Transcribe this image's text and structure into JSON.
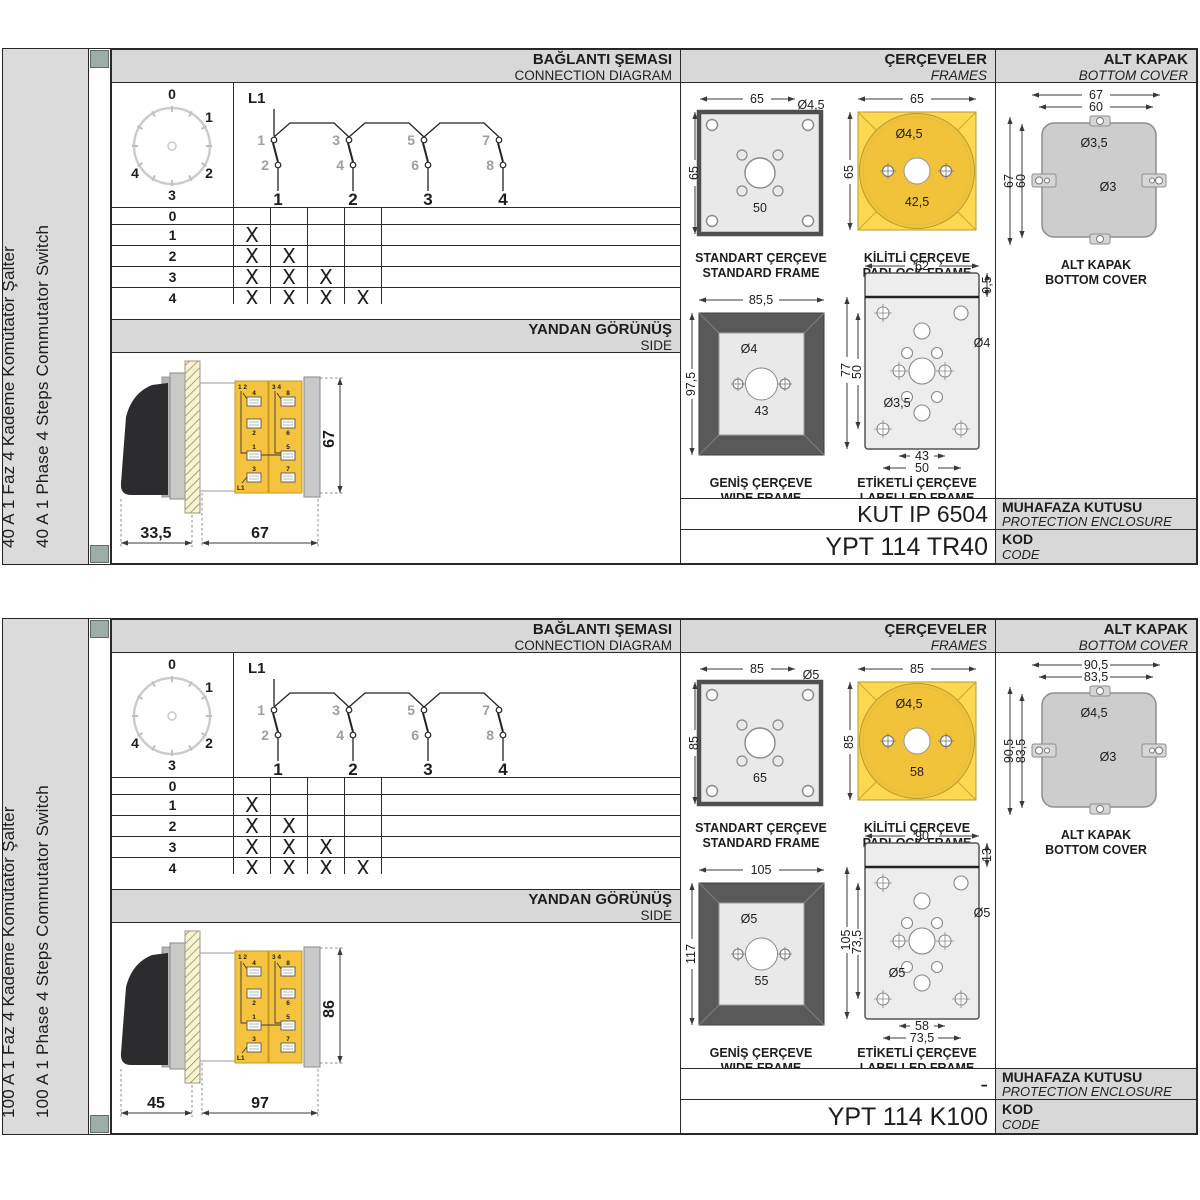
{
  "colors": {
    "header_gray": "#D8D8D8",
    "tab_green": "#9FADA9",
    "switch_yellow": "#F6C33E",
    "padlock_yellow": "#FDD850",
    "padlock_circle": "#F3C23B",
    "frame_dark": "#595959",
    "cover_gray": "#CDCDCD",
    "dial_ring": "#C7CECA"
  },
  "sections": [
    {
      "label_tr": "40 A 1 Faz 4 Kademe Komütatör Şalter",
      "label_en": "40 A 1 Phase 4 Steps Commutator Switch",
      "hdr_conn_tr": "BAĞLANTI ŞEMASI",
      "hdr_conn_en": "CONNECTION DIAGRAM",
      "hdr_frames_tr": "ÇERÇEVELER",
      "hdr_frames_en": "FRAMES",
      "hdr_cover_tr": "ALT KAPAK",
      "hdr_cover_en": "BOTTOM COVER",
      "hdr_side_tr": "YANDAN GÖRÜNÜŞ",
      "hdr_side_en": "SIDE",
      "dial": {
        "positions": [
          "0",
          "1",
          "2",
          "3",
          "4"
        ]
      },
      "schem": {
        "source": "L1",
        "top": [
          "1",
          "3",
          "5",
          "7"
        ],
        "bottom": [
          "2",
          "4",
          "6",
          "8"
        ],
        "cols": [
          "1",
          "2",
          "3",
          "4"
        ]
      },
      "table": {
        "rows": [
          {
            "label": "0",
            "marks": [
              "",
              "",
              "",
              ""
            ]
          },
          {
            "label": "1",
            "marks": [
              "X",
              "",
              "",
              ""
            ]
          },
          {
            "label": "2",
            "marks": [
              "X",
              "X",
              "",
              ""
            ]
          },
          {
            "label": "3",
            "marks": [
              "X",
              "X",
              "X",
              ""
            ]
          },
          {
            "label": "4",
            "marks": [
              "X",
              "X",
              "X",
              "X"
            ]
          }
        ]
      },
      "side": {
        "dim_a": "33,5",
        "dim_b": "67",
        "dim_h": "67",
        "modules": [
          {
            "corner": "1 2",
            "t1": "4",
            "t2": "2",
            "t3": "1",
            "t4": "3",
            "source": "L1"
          },
          {
            "corner": "3 4",
            "t1": "8",
            "t2": "6",
            "t3": "5",
            "t4": "7",
            "source": ""
          }
        ]
      },
      "frames": {
        "standard": {
          "tr": "STANDART ÇERÇEVE",
          "en": "STANDARD FRAME",
          "w": "65",
          "h": "65",
          "hole": "Ø4,5",
          "inner": "50"
        },
        "padlock": {
          "tr": "KİLİTLİ ÇERÇEVE",
          "en": "PADLOCK FRAME",
          "w": "65",
          "h": "65",
          "hole": "Ø4,5",
          "inner": "42,5"
        },
        "wide": {
          "tr": "GENİŞ ÇERÇEVE",
          "en": "WIDE FRAME",
          "w": "85,5",
          "h": "97,5",
          "hole": "Ø4",
          "inner": "43"
        },
        "labelled": {
          "tr": "ETİKETLİ ÇERÇEVE",
          "en": "LABELLED FRAME",
          "w": "62",
          "strip": "9,5",
          "h": "77",
          "inner_h": "50",
          "hole_mid": "Ø4",
          "hole_corner": "Ø3,5",
          "inner_w": "43",
          "outer_w": "50"
        }
      },
      "cover": {
        "cap_tr": "ALT KAPAK",
        "cap_en": "BOTTOM COVER",
        "outer_w": "67",
        "inner_w": "60",
        "outer_h": "67",
        "inner_h": "60",
        "hole_big": "Ø3,5",
        "hole_small": "Ø3"
      },
      "enclosure": {
        "value": "KUT IP 6504",
        "tr": "MUHAFAZA KUTUSU",
        "en": "PROTECTION ENCLOSURE"
      },
      "code": {
        "value": "YPT 114 TR40",
        "tr": "KOD",
        "en": "CODE"
      }
    },
    {
      "label_tr": "100 A 1 Faz 4 Kademe Komütatör Şalter",
      "label_en": "100 A 1 Phase 4 Steps Commutator Switch",
      "hdr_conn_tr": "BAĞLANTI ŞEMASI",
      "hdr_conn_en": "CONNECTION DIAGRAM",
      "hdr_frames_tr": "ÇERÇEVELER",
      "hdr_frames_en": "FRAMES",
      "hdr_cover_tr": "ALT KAPAK",
      "hdr_cover_en": "BOTTOM COVER",
      "hdr_side_tr": "YANDAN GÖRÜNÜŞ",
      "hdr_side_en": "SIDE",
      "dial": {
        "positions": [
          "0",
          "1",
          "2",
          "3",
          "4"
        ]
      },
      "schem": {
        "source": "L1",
        "top": [
          "1",
          "3",
          "5",
          "7"
        ],
        "bottom": [
          "2",
          "4",
          "6",
          "8"
        ],
        "cols": [
          "1",
          "2",
          "3",
          "4"
        ]
      },
      "table": {
        "rows": [
          {
            "label": "0",
            "marks": [
              "",
              "",
              "",
              ""
            ]
          },
          {
            "label": "1",
            "marks": [
              "X",
              "",
              "",
              ""
            ]
          },
          {
            "label": "2",
            "marks": [
              "X",
              "X",
              "",
              ""
            ]
          },
          {
            "label": "3",
            "marks": [
              "X",
              "X",
              "X",
              ""
            ]
          },
          {
            "label": "4",
            "marks": [
              "X",
              "X",
              "X",
              "X"
            ]
          }
        ]
      },
      "side": {
        "dim_a": "45",
        "dim_b": "97",
        "dim_h": "86",
        "modules": [
          {
            "corner": "1 2",
            "t1": "4",
            "t2": "2",
            "t3": "1",
            "t4": "3",
            "source": "L1"
          },
          {
            "corner": "3 4",
            "t1": "8",
            "t2": "6",
            "t3": "5",
            "t4": "7",
            "source": ""
          }
        ]
      },
      "frames": {
        "standard": {
          "tr": "STANDART ÇERÇEVE",
          "en": "STANDARD FRAME",
          "w": "85",
          "h": "85",
          "hole": "Ø5",
          "inner": "65"
        },
        "padlock": {
          "tr": "KİLİTLİ ÇERÇEVE",
          "en": "PADLOCK FRAME",
          "w": "85",
          "h": "85",
          "hole": "Ø4,5",
          "inner": "58"
        },
        "wide": {
          "tr": "GENİŞ ÇERÇEVE",
          "en": "WIDE FRAME",
          "w": "105",
          "h": "117",
          "hole": "Ø5",
          "inner": "55"
        },
        "labelled": {
          "tr": "ETİKETLİ ÇERÇEVE",
          "en": "LABELLED FRAME",
          "w": "90",
          "strip": "13",
          "h": "105",
          "inner_h": "73,5",
          "hole_mid": "Ø5",
          "hole_corner": "Ø5",
          "inner_w": "58",
          "outer_w": "73,5"
        }
      },
      "cover": {
        "cap_tr": "ALT KAPAK",
        "cap_en": "BOTTOM COVER",
        "outer_w": "90,5",
        "inner_w": "83,5",
        "outer_h": "90,5",
        "inner_h": "83,5",
        "hole_big": "Ø4,5",
        "hole_small": "Ø3"
      },
      "enclosure": {
        "value": "-",
        "tr": "MUHAFAZA KUTUSU",
        "en": "PROTECTION ENCLOSURE"
      },
      "code": {
        "value": "YPT 114 K100",
        "tr": "KOD",
        "en": "CODE"
      }
    }
  ]
}
